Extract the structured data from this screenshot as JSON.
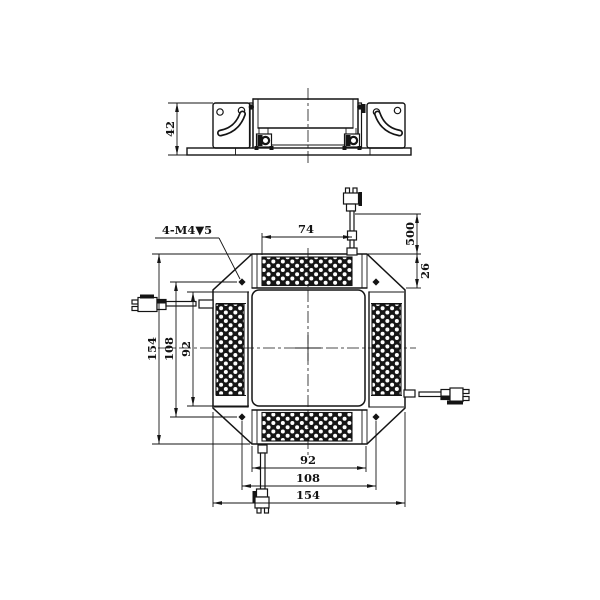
{
  "colors": {
    "line": "#141414",
    "background": "#ffffff"
  },
  "side_view": {
    "dim_height": "42"
  },
  "front_view": {
    "thread_callout": "4-M4▼5",
    "dim_top_width": "74",
    "dim_cable_length": "500",
    "dim_corner_offset": "26",
    "dim_left_outer": "154",
    "dim_left_holes": "108",
    "dim_left_inner": "92",
    "dim_bottom_inner": "92",
    "dim_bottom_holes": "108",
    "dim_bottom_outer": "154"
  }
}
